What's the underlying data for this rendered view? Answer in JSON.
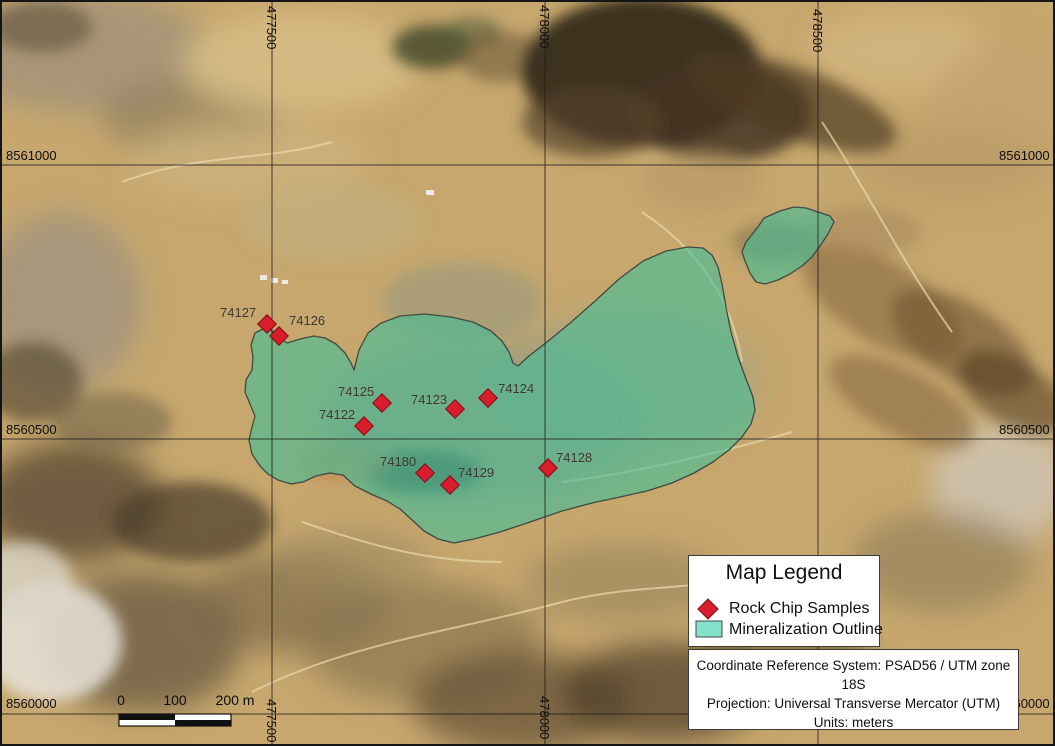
{
  "axes": {
    "top": [
      "477500",
      "478000",
      "478500"
    ],
    "bottom": [
      "477500",
      "478000"
    ],
    "left": [
      "8561000",
      "8560500",
      "8560000"
    ],
    "right": [
      "8561000",
      "8560500",
      "8560000"
    ]
  },
  "samples": [
    {
      "id": "74127"
    },
    {
      "id": "74126"
    },
    {
      "id": "74125"
    },
    {
      "id": "74123"
    },
    {
      "id": "74124"
    },
    {
      "id": "74122"
    },
    {
      "id": "74180"
    },
    {
      "id": "74129"
    },
    {
      "id": "74128"
    }
  ],
  "legend": {
    "title": "Map Legend",
    "items": [
      {
        "label": "Rock Chip Samples",
        "symbol": "red-diamond"
      },
      {
        "label": "Mineralization Outline",
        "symbol": "teal-polygon"
      }
    ]
  },
  "crs": {
    "line1": "Coordinate Reference System: PSAD56 / UTM zone 18S",
    "line2": "Projection: Universal Transverse Mercator (UTM)",
    "line3": "Units: meters"
  },
  "scalebar": {
    "tick0": "0",
    "tick1": "100",
    "tick2": "200 m"
  },
  "colors": {
    "sample_marker": "#d81e2c",
    "sample_marker_border": "#8e0f18",
    "mineralization_fill": "#3dbf9b",
    "mineralization_outline": "#3f4a42",
    "legend_swatch": "#84e0c8"
  }
}
